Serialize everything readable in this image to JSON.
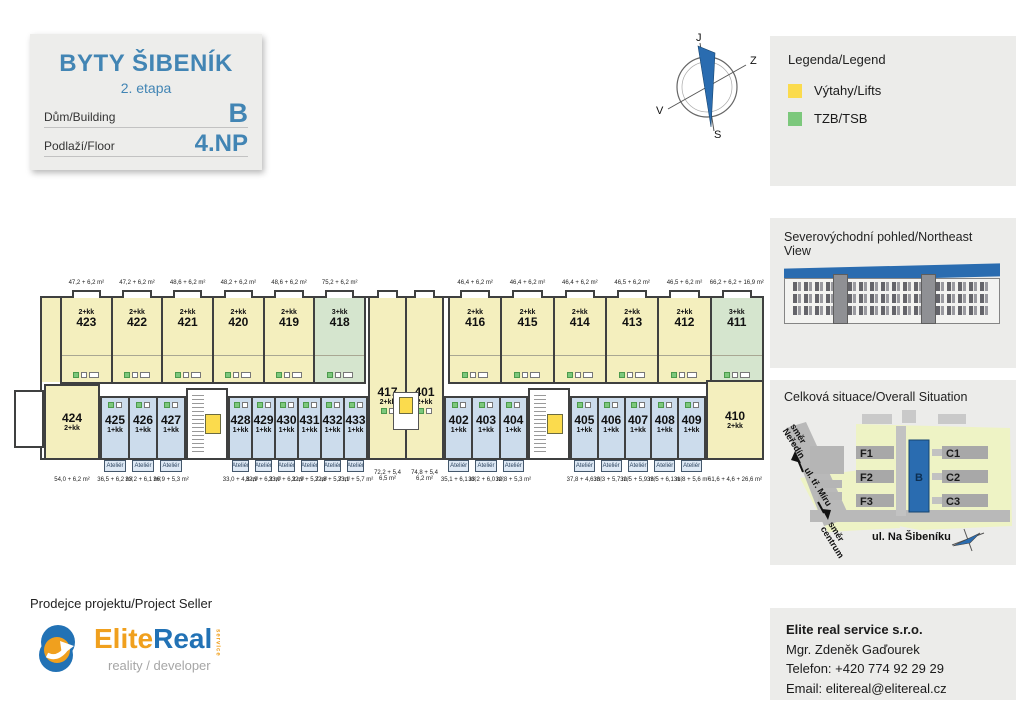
{
  "title_box": {
    "title": "BYTY ŠIBENÍK",
    "subtitle": "2. etapa",
    "building_label": "Dům/Building",
    "building_value": "B",
    "floor_label": "Podlaží/Floor",
    "floor_value": "4.NP"
  },
  "compass": {
    "top": "J",
    "right": "Z",
    "left": "V",
    "bottom": "S"
  },
  "legend": {
    "title": "Legenda/Legend",
    "items": [
      {
        "label": "Výtahy/Lifts",
        "color": "#fbdb4d"
      },
      {
        "label": "TZB/TSB",
        "color": "#7cc87c"
      }
    ]
  },
  "northeast_view": {
    "title": "Severovýchodní pohled/Northeast View"
  },
  "situation": {
    "title": "Celková situace/Overall Situation",
    "buildings": {
      "f1": "F1",
      "f2": "F2",
      "f3": "F3",
      "b": "B",
      "c1": "C1",
      "c2": "C2",
      "c3": "C3"
    },
    "streets": {
      "dir_top_1": "směr",
      "dir_top_2": "Neředín",
      "road": "ul. tř. Míru",
      "dir_bot_1": "směr",
      "dir_bot_2": "centrum",
      "main": "ul. Na Šibeníku"
    }
  },
  "seller": {
    "label": "Prodejce projektu/Project Seller",
    "brand_elite": "Elite",
    "brand_real": "Real",
    "brand_service": "service",
    "brand_tagline": "reality / developer"
  },
  "contact": {
    "company": "Elite real service s.r.o.",
    "person": "Mgr. Zdeněk Gaďourek",
    "phone": "Telefon: +420 774 92 29 29",
    "email": "Email: elitereal@elitereal.cz"
  },
  "colors": {
    "accent_blue": "#4285b4",
    "unit_yellow": "#f4efbe",
    "unit_blue": "#ccdcec",
    "unit_green": "#d5e5ce",
    "lift_yellow": "#fbdb4d",
    "tzb_green": "#7cc87c",
    "wall": "#3f4040",
    "building_highlight": "#2a6cb0"
  },
  "floorplan": {
    "atelier_label": "Ateliér",
    "groups": {
      "top_left": [
        {
          "no": "423",
          "type": "2+kk",
          "area": "47,2 + 6,2 m²",
          "color": "yellow"
        },
        {
          "no": "422",
          "type": "2+kk",
          "area": "47,2 + 6,2 m²",
          "color": "yellow"
        },
        {
          "no": "421",
          "type": "2+kk",
          "area": "48,6 + 6,2 m²",
          "color": "yellow"
        },
        {
          "no": "420",
          "type": "2+kk",
          "area": "48,2 + 6,2 m²",
          "color": "yellow"
        },
        {
          "no": "419",
          "type": "2+kk",
          "area": "48,6 + 6,2 m²",
          "color": "yellow"
        },
        {
          "no": "418",
          "type": "3+kk",
          "area": "75,2 + 6,2 m²",
          "color": "green"
        }
      ],
      "top_right": [
        {
          "no": "416",
          "type": "2+kk",
          "area": "46,4 + 6,2 m²",
          "color": "yellow"
        },
        {
          "no": "415",
          "type": "2+kk",
          "area": "46,4 + 6,2 m²",
          "color": "yellow"
        },
        {
          "no": "414",
          "type": "2+kk",
          "area": "46,4 + 6,2 m²",
          "color": "yellow"
        },
        {
          "no": "413",
          "type": "2+kk",
          "area": "46,5 + 6,2 m²",
          "color": "yellow"
        },
        {
          "no": "412",
          "type": "2+kk",
          "area": "46,5 + 6,2 m²",
          "color": "yellow"
        },
        {
          "no": "411",
          "type": "3+kk",
          "area": "66,2 + 6,2 + 16,9 m²",
          "color": "green"
        }
      ],
      "mid": [
        {
          "no": "417",
          "type": "2+kk",
          "area": "72,2 + 5,4",
          "area2": "6,5 m²",
          "color": "yellow"
        },
        {
          "no": "401",
          "type": "2+kk",
          "area": "74,8 + 5,4",
          "area2": "6,2 m²",
          "color": "yellow"
        }
      ],
      "bottom_a": [
        {
          "no": "425",
          "type": "1+kk",
          "area": "36,5 + 6,2 m²",
          "color": "blue"
        },
        {
          "no": "426",
          "type": "1+kk",
          "area": "33,2 + 6,1 m²",
          "color": "blue"
        },
        {
          "no": "427",
          "type": "1+kk",
          "area": "36,9 + 5,3 m²",
          "color": "blue"
        }
      ],
      "bottom_b": [
        {
          "no": "428",
          "type": "1+kk",
          "area": "33,0 + 4,6 m²",
          "color": "blue"
        },
        {
          "no": "429",
          "type": "1+kk",
          "area": "32,9 + 6,2 m²",
          "color": "blue"
        },
        {
          "no": "430",
          "type": "1+kk",
          "area": "33,0 + 6,2 m²",
          "color": "blue"
        },
        {
          "no": "431",
          "type": "1+kk",
          "area": "32,9 + 5,7 m²",
          "color": "blue"
        },
        {
          "no": "432",
          "type": "1+kk",
          "area": "32,8 + 5,7 m²",
          "color": "blue"
        },
        {
          "no": "433",
          "type": "1+kk",
          "area": "33,1 + 5,7 m²",
          "color": "blue"
        }
      ],
      "bottom_c": [
        {
          "no": "402",
          "type": "1+kk",
          "area": "35,1 + 6,1 m²",
          "color": "blue"
        },
        {
          "no": "403",
          "type": "1+kk",
          "area": "33,2 + 6,0 m²",
          "color": "blue"
        },
        {
          "no": "404",
          "type": "1+kk",
          "area": "32,8 + 5,3 m²",
          "color": "blue"
        }
      ],
      "bottom_d": [
        {
          "no": "405",
          "type": "1+kk",
          "area": "37,8 + 4,6 m²",
          "color": "blue"
        },
        {
          "no": "406",
          "type": "1+kk",
          "area": "33,3 + 5,7 m²",
          "color": "blue"
        },
        {
          "no": "407",
          "type": "1+kk",
          "area": "32,5 + 5,9 m²",
          "color": "blue"
        },
        {
          "no": "408",
          "type": "1+kk",
          "area": "33,5 + 6,1 m²",
          "color": "blue"
        },
        {
          "no": "409",
          "type": "1+kk",
          "area": "31,8 + 5,6 m²",
          "color": "blue"
        }
      ]
    },
    "end_left": {
      "no": "424",
      "type": "2+kk",
      "area": "54,0 + 6,2 m²"
    },
    "end_right": {
      "no": "410",
      "type": "2+kk",
      "area": "61,6 + 4,6 + 26,6 m²"
    }
  }
}
